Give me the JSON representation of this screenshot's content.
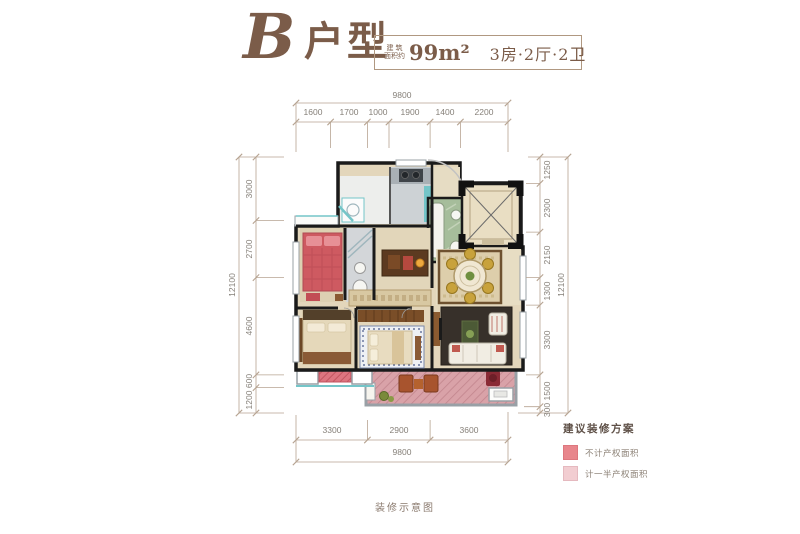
{
  "title": {
    "letter": "B",
    "type_label": "户型",
    "area_prefix_top": "建 筑",
    "area_prefix_bottom": "面积约",
    "area_value": "99m²",
    "rooms_label": "3房·2厅·2卫"
  },
  "dimensions": {
    "top": {
      "total": "9800",
      "segments": [
        "1600",
        "1700",
        "1000",
        "1900",
        "1400",
        "2200"
      ]
    },
    "bottom": {
      "total": "9800",
      "segments": [
        "3300",
        "2900",
        "3600"
      ]
    },
    "left": {
      "total": "12100",
      "segments": [
        "3000",
        "2700",
        "4600",
        "600",
        "1200"
      ]
    },
    "right": {
      "total": "12100",
      "segments": [
        "1250",
        "2300",
        "2150",
        "1300",
        "3300",
        "1500",
        "300"
      ]
    }
  },
  "legend": {
    "title": "建议装修方案",
    "items": [
      {
        "label": "不计产权面积",
        "color": "#e8868c"
      },
      {
        "label": "计一半产权面积",
        "color": "#f2cdd1"
      }
    ]
  },
  "caption": "装修示意图",
  "colors": {
    "title_brown": "#7b5c49",
    "dim_line": "#b7a492",
    "dim_text": "#868079",
    "wall": "#1a1a1a",
    "balcony_pink": "#d9a2a8",
    "red_no_property_area": "#d4646e",
    "teal_accent": "#74c5c8"
  }
}
